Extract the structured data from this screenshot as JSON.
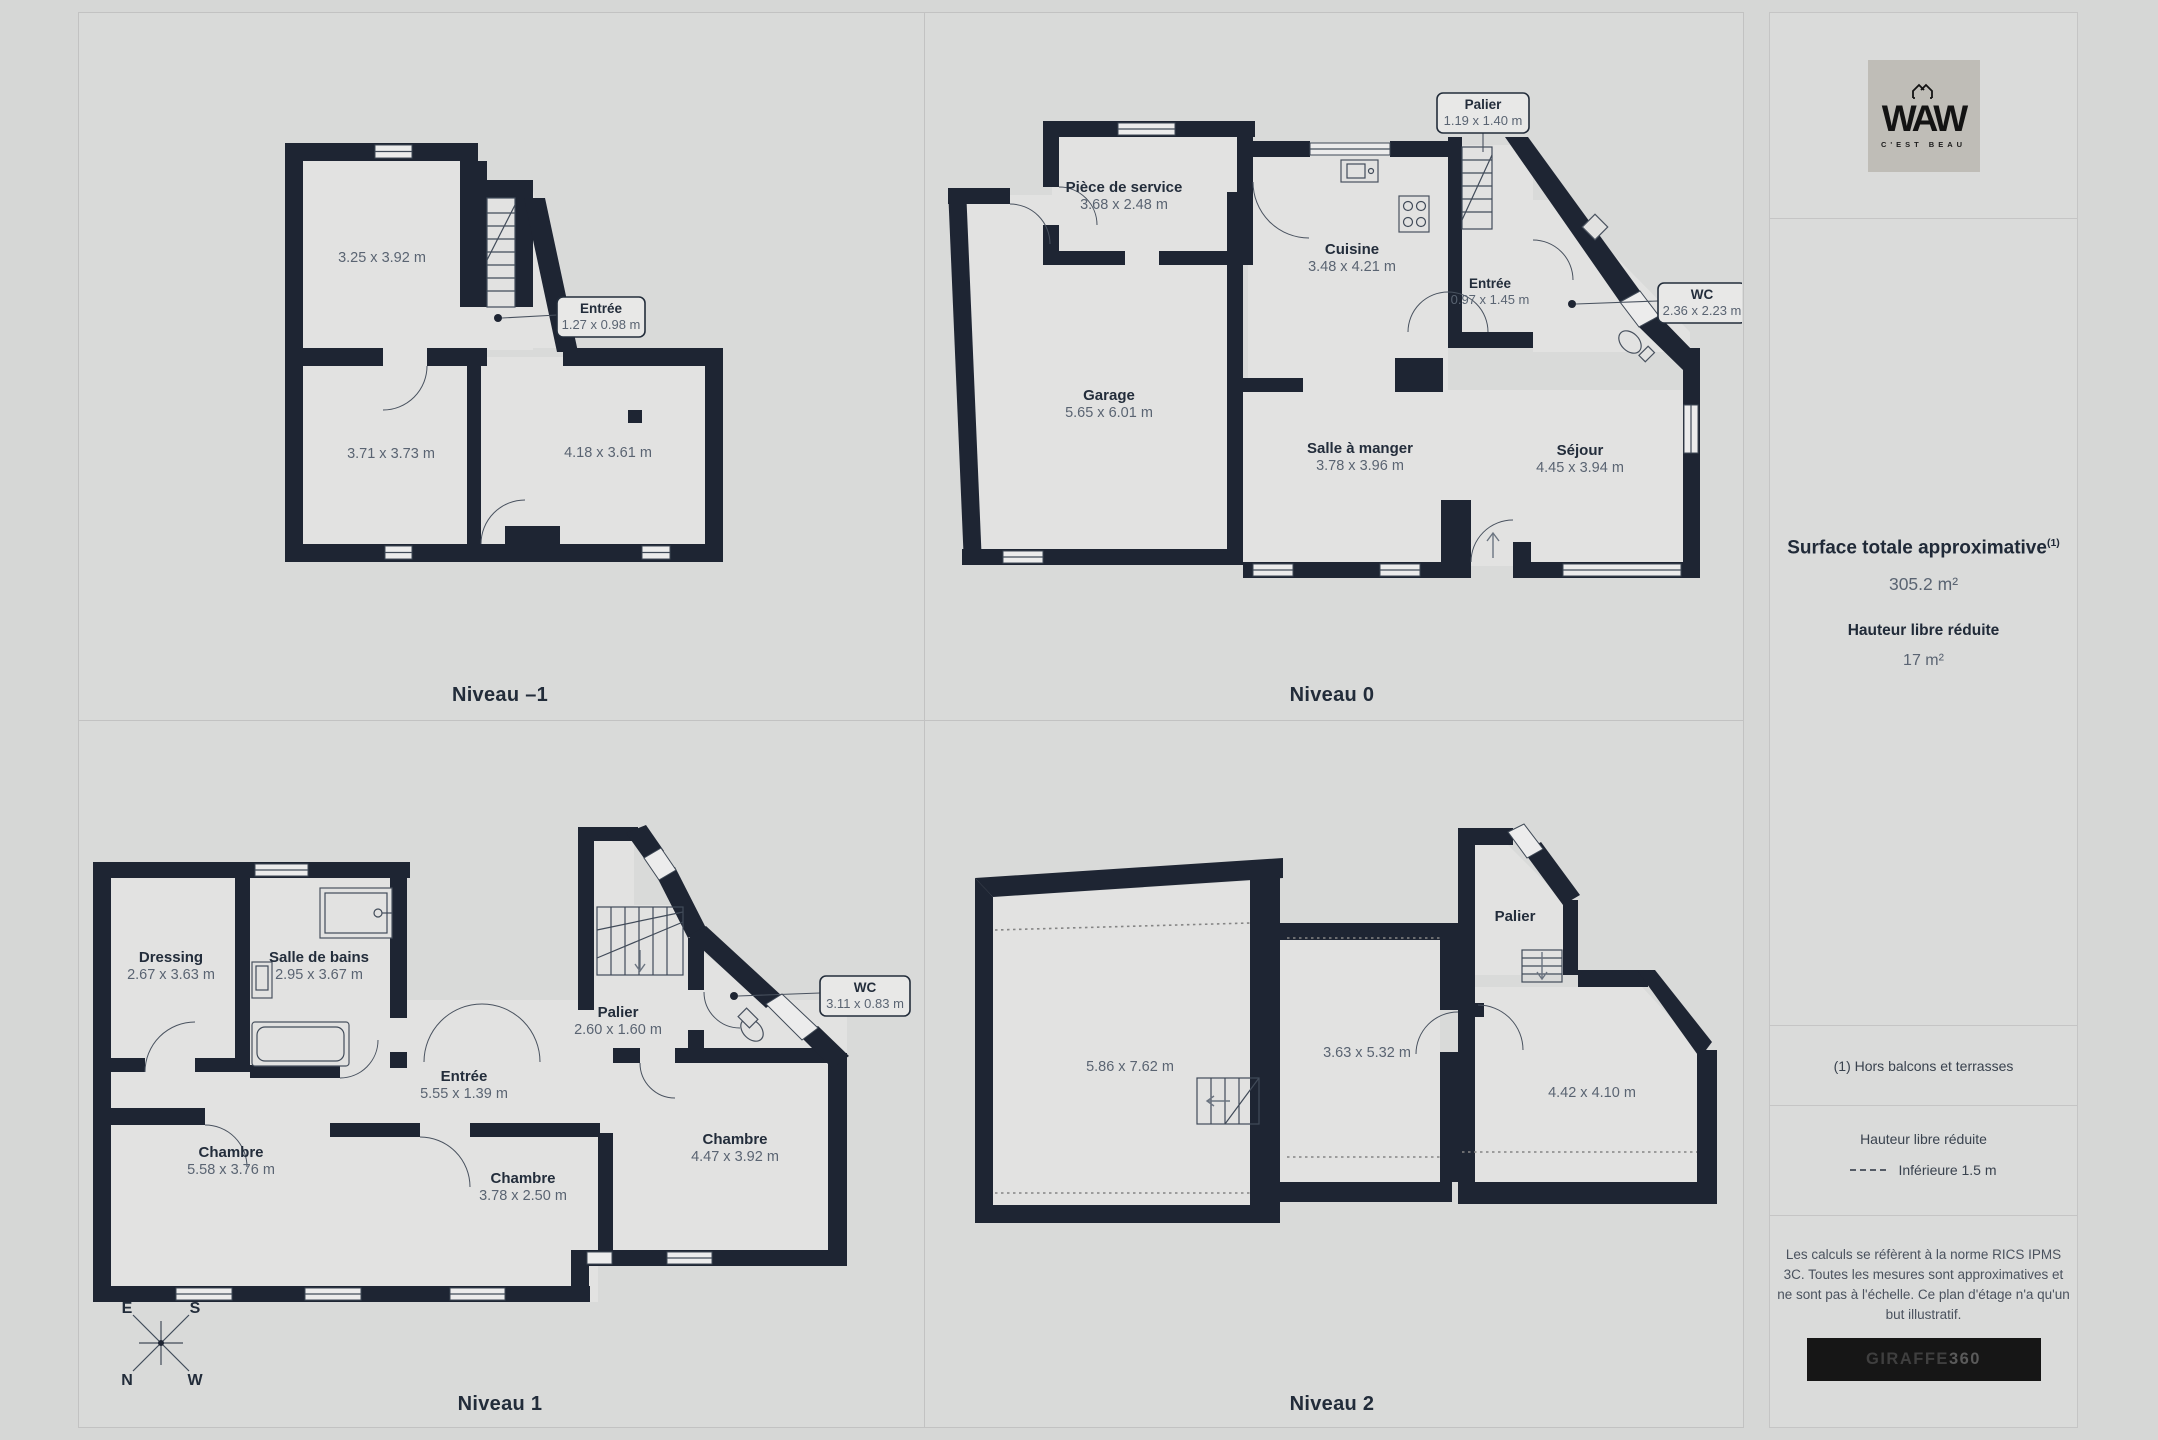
{
  "sidebar": {
    "logo": {
      "brand": "WAW",
      "tagline": "C'EST BEAU"
    },
    "surface_title": "Surface totale approximative",
    "surface_sup": "(1)",
    "surface_value": "305.2 m²",
    "height_title": "Hauteur libre réduite",
    "height_value": "17 m²",
    "footnote": "(1) Hors balcons et terrasses",
    "legend_title": "Hauteur libre réduite",
    "legend_label": "Inférieure 1.5 m",
    "disclaimer": "Les calculs se réfèrent à la norme RICS IPMS 3C. Toutes les mesures sont approximatives et ne sont pas à l'échelle. Ce plan d'étage n'a qu'un but illustratif.",
    "brand_footer": {
      "name": "GIRAFFE",
      "suffix": "360"
    }
  },
  "compass": {
    "n": "N",
    "s": "S",
    "e": "E",
    "w": "W"
  },
  "levels": [
    {
      "label": "Niveau –1",
      "rooms": [
        {
          "name": "",
          "dims": "3.25 x 3.92 m"
        },
        {
          "name": "",
          "dims": "3.71 x 3.73 m"
        },
        {
          "name": "",
          "dims": "4.18 x 3.61 m"
        }
      ],
      "callouts": [
        {
          "name": "Entrée",
          "dims": "1.27 x 0.98 m"
        }
      ]
    },
    {
      "label": "Niveau 0",
      "rooms": [
        {
          "name": "Pièce de service",
          "dims": "3.68 x 2.48 m"
        },
        {
          "name": "Cuisine",
          "dims": "3.48 x 4.21 m"
        },
        {
          "name": "Garage",
          "dims": "5.65 x 6.01 m"
        },
        {
          "name": "Salle à manger",
          "dims": "3.78 x 3.96 m"
        },
        {
          "name": "Séjour",
          "dims": "4.45 x 3.94 m"
        },
        {
          "name": "Entrée",
          "dims": "0.97 x 1.45 m"
        }
      ],
      "callouts": [
        {
          "name": "Palier",
          "dims": "1.19 x 1.40 m"
        },
        {
          "name": "WC",
          "dims": "2.36 x 2.23 m"
        }
      ]
    },
    {
      "label": "Niveau 1",
      "rooms": [
        {
          "name": "Dressing",
          "dims": "2.67 x 3.63 m"
        },
        {
          "name": "Salle de bains",
          "dims": "2.95 x 3.67 m"
        },
        {
          "name": "Palier",
          "dims": "2.60 x 1.60 m"
        },
        {
          "name": "Entrée",
          "dims": "5.55 x 1.39 m"
        },
        {
          "name": "Chambre",
          "dims": "5.58 x 3.76 m"
        },
        {
          "name": "Chambre",
          "dims": "3.78 x 2.50 m"
        },
        {
          "name": "Chambre",
          "dims": "4.47 x 3.92 m"
        }
      ],
      "callouts": [
        {
          "name": "WC",
          "dims": "3.11 x 0.83 m"
        }
      ]
    },
    {
      "label": "Niveau 2",
      "rooms": [
        {
          "name": "",
          "dims": "5.86 x 7.62 m"
        },
        {
          "name": "",
          "dims": "3.63 x 5.32 m"
        },
        {
          "name": "",
          "dims": "4.42 x 4.10 m"
        },
        {
          "name": "Palier",
          "dims": ""
        }
      ],
      "callouts": []
    }
  ]
}
